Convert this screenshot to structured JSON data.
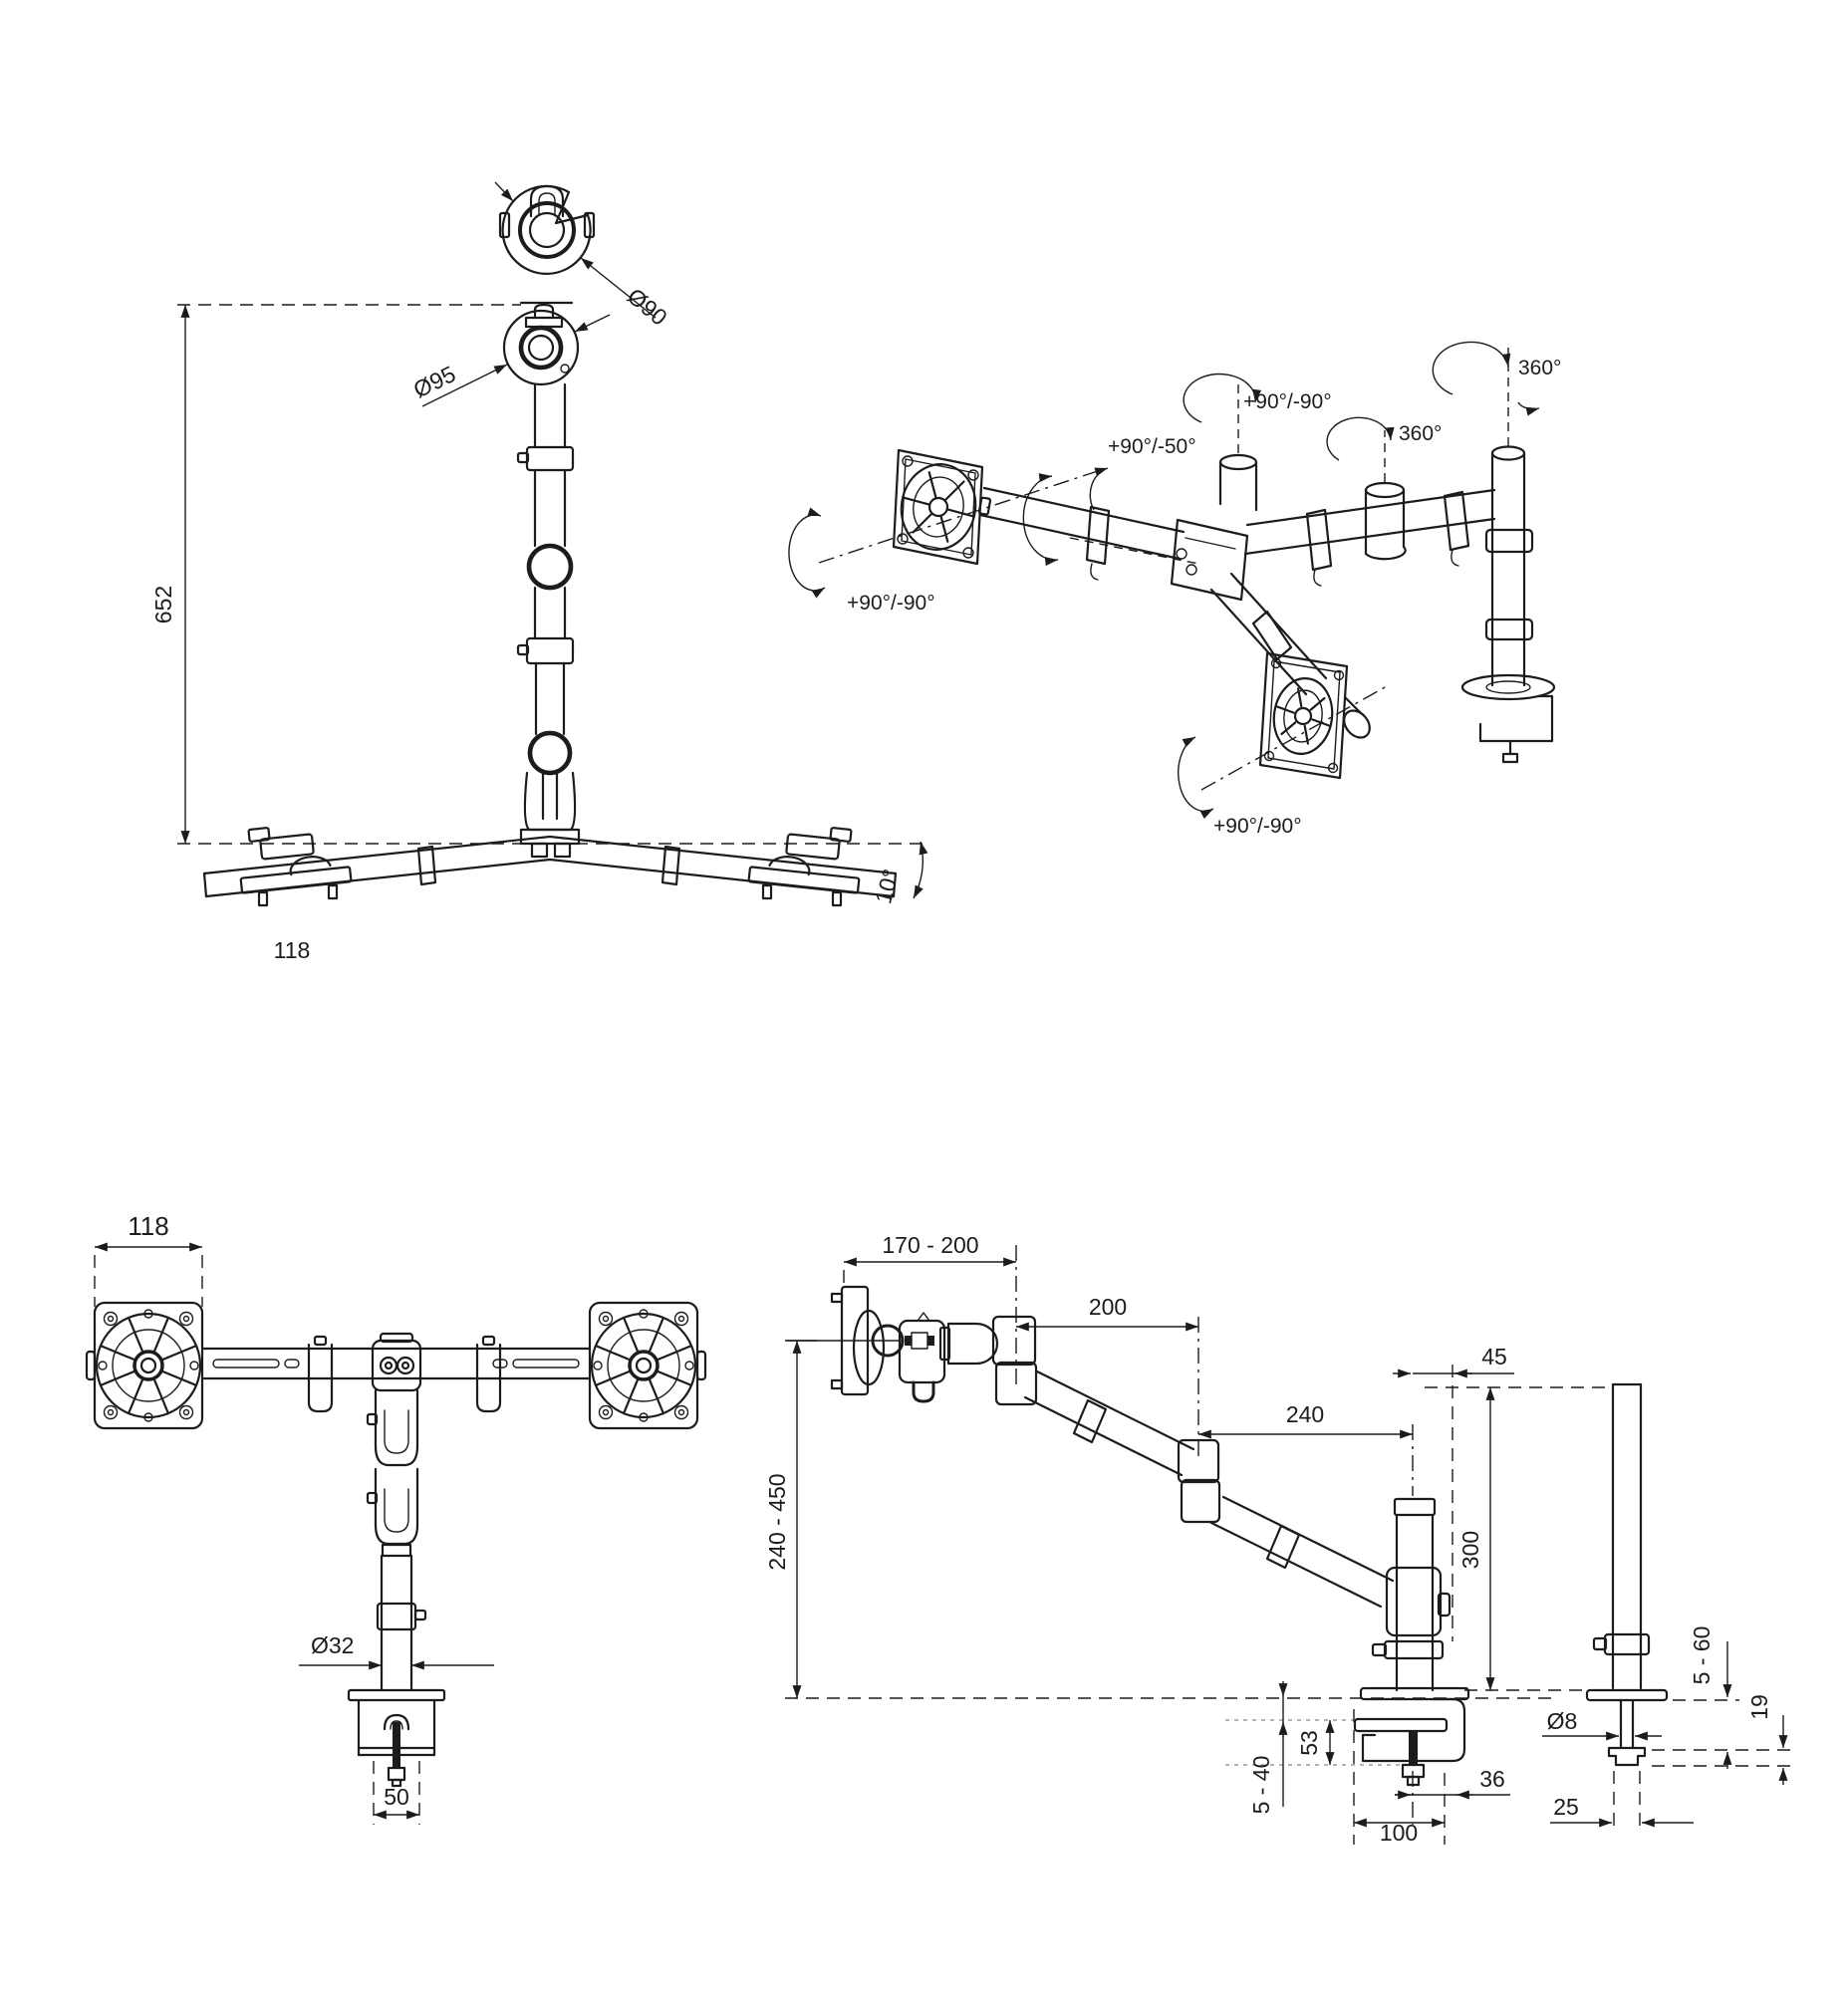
{
  "views": {
    "side": {
      "height": "652",
      "top_diameter": "Ø90",
      "ring_diameter": "Ø95",
      "tilt_angle": "10°",
      "foot_width": "118"
    },
    "iso": {
      "vesa_left": "+90°/-90°",
      "arm_tilt": "+90°/-50°",
      "head_pivot": "+90°/-90°",
      "mid_rotation": "360°",
      "pole_rotation": "360°",
      "vesa_bottom": "+90°/-90°"
    },
    "front": {
      "vesa_width": "118",
      "pole_diameter": "Ø32",
      "clamp_width": "50"
    },
    "arm_side": {
      "head_depth": "170 - 200",
      "upper_arm": "200",
      "lower_arm": "240",
      "pole_offset": "45",
      "height_range": "240 - 450",
      "pole_height": "300",
      "desk_thickness": "5 - 60",
      "washer_height": "19",
      "bolt_diameter": "Ø8",
      "clamp_inner": "53",
      "clamp_range": "5 - 40",
      "clamp_depth": "36",
      "clamp_throat": "100",
      "grommet_width": "25"
    }
  },
  "colors": {
    "line": "#1c1c1c",
    "background": "#ffffff",
    "dim_gray": "#9c9c9c"
  }
}
